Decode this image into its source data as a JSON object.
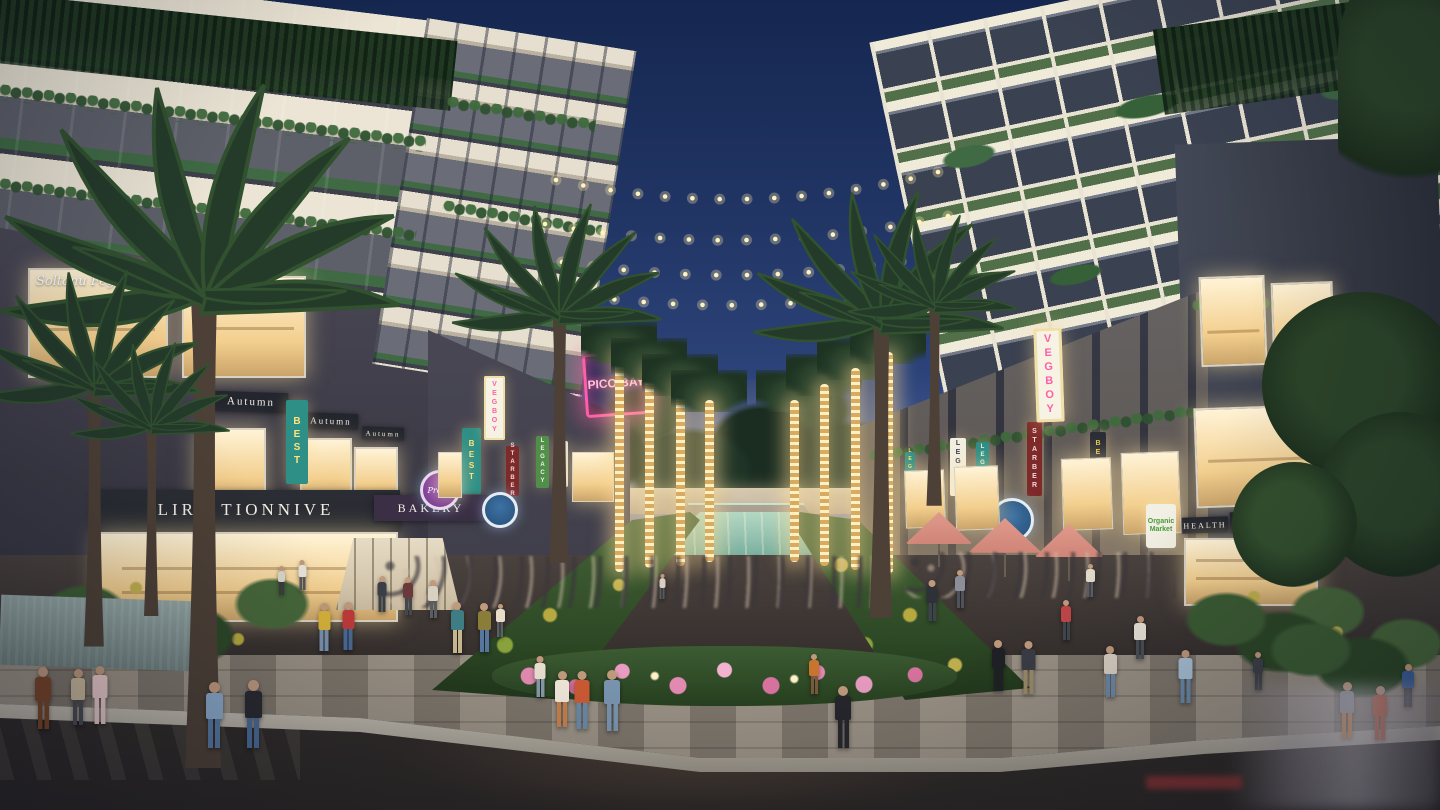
{
  "colors": {
    "sky_top": "#152750",
    "sky_mid": "#2c4379",
    "sky_horizon": "#8b8fae",
    "water": "#4f9184",
    "window_glow": "#ffe8b8",
    "building_dark": "#3e4350",
    "building_cream": "#e9e2d2",
    "neon_pink": "#ff5fa8",
    "banner_teal": "#2e8f86",
    "banner_yellow": "#e8c84a",
    "banner_red": "#7e2a2a",
    "umbrella": "#cf8578",
    "flower_pink": "#e48bb2",
    "string_light": "#fff3c4"
  },
  "signs": {
    "soltanu_fegaro": "Soltanu Fegaro",
    "autumn": "Autumn",
    "liru_tionnive": "LIRU TIONNIVE",
    "bakery": "BAKERY",
    "pretty": "Pretty",
    "best": "BEST",
    "vegboy": "VEGBOY",
    "starber": "STARBER",
    "legacy": "LEGACY",
    "pico_bay": "PICO BAY",
    "health": "HEALTH",
    "organics": "ORGANICS",
    "organic_market_line1": "Organic",
    "organic_market_line2": "Market"
  }
}
